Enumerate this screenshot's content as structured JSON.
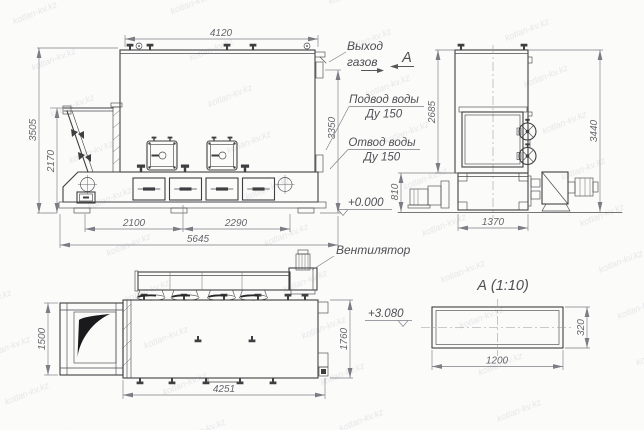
{
  "drawing": {
    "watermark": "kotlan-kv.kz",
    "colors": {
      "line": "#3f3f42",
      "dimension": "#7c7c84",
      "background": "#fbfbfa",
      "shade": "#1a1a1c"
    },
    "labels": {
      "gas_outlet_line1": "Выход",
      "gas_outlet_line2": "газов",
      "view_arrow_letter": "А",
      "water_supply_line1": "Подвод воды",
      "water_supply_line2": "Ду 150",
      "water_return_line1": "Отвод воды",
      "water_return_line2": "Ду 150",
      "fan": "Вентилятор",
      "level_zero": "+0.000",
      "level_gas_axis": "+3.080",
      "section_title": "А (1:10)"
    },
    "dimensions": {
      "front": {
        "width_top": "4120",
        "height_total": "3505",
        "height_hopper": "2170",
        "height_gas_outlet": "3350",
        "base_span_left": "2100",
        "base_span_right": "2290",
        "length_total": "5645"
      },
      "side": {
        "height_body": "2685",
        "height_total": "3440",
        "height_base": "810",
        "base_width": "1370"
      },
      "plan": {
        "hopper_width": "1500",
        "body_length": "4251",
        "body_width": "1760"
      },
      "section_a": {
        "width": "1200",
        "height": "320"
      }
    }
  }
}
